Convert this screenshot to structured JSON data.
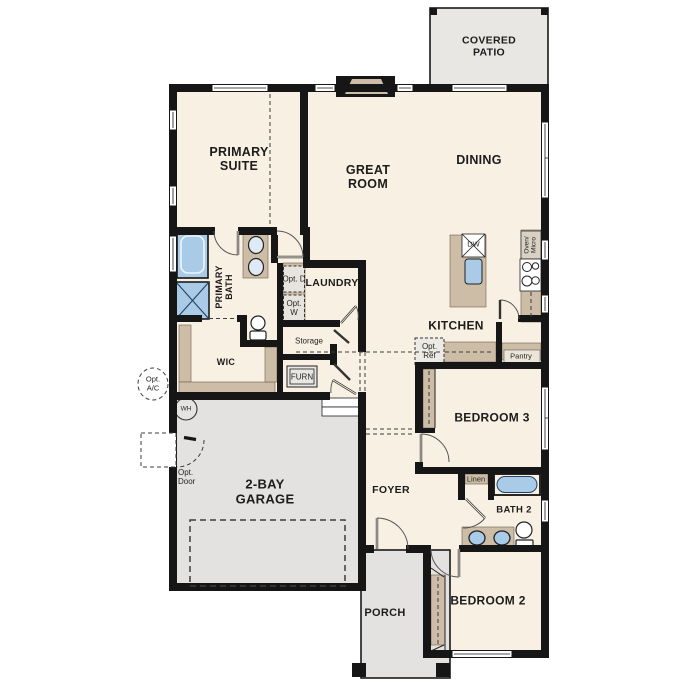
{
  "plan": {
    "title": "single-story floor plan",
    "rooms": {
      "covered_patio": "COVERED PATIO",
      "primary_suite": "PRIMARY SUITE",
      "great_room": "GREAT ROOM",
      "dining": "DINING",
      "primary_bath": "PRIMARY BATH",
      "laundry": "LAUNDRY",
      "wic": "WIC",
      "kitchen": "KITCHEN",
      "bedroom3": "BEDROOM 3",
      "garage": "2-BAY GARAGE",
      "foyer": "FOYER",
      "bath2": "BATH 2",
      "bedroom2": "BEDROOM 2",
      "porch": "PORCH"
    },
    "features": {
      "storage": "Storage",
      "furn": "FURN",
      "linen": "Linen",
      "pantry": "Pantry",
      "dw": "DW",
      "oven_micro": "Oven/ Micro",
      "wh": "WH",
      "opt_ac": "Opt. A/C",
      "opt_door": "Opt. Door",
      "opt_ref": "Opt. Ref",
      "opt_d": "Opt. D",
      "opt_w": "Opt. W"
    },
    "colors": {
      "floor": "#f8f0e3",
      "wall": "#161616",
      "counter": "#cdbda6",
      "concrete": "#e3e2e0",
      "fixture_blue": "#a9cbe8",
      "patio": "#e8e7e4"
    }
  }
}
